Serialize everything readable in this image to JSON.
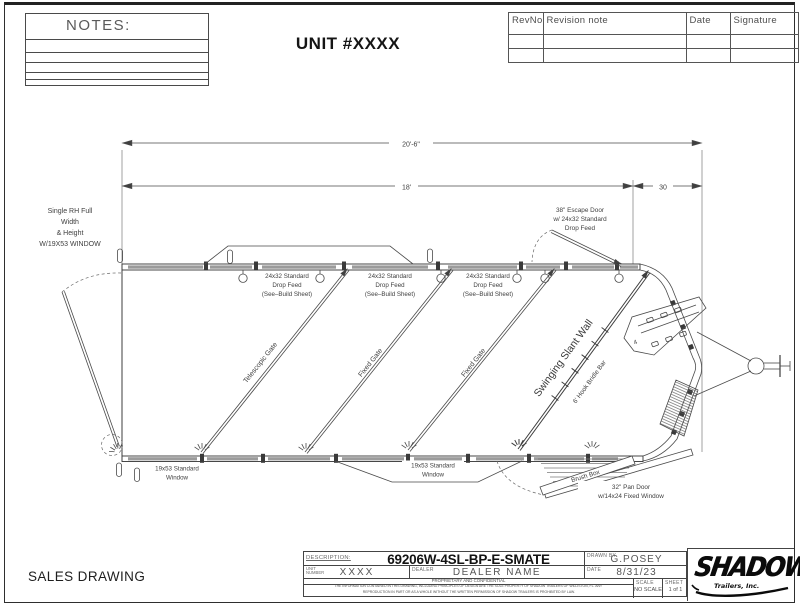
{
  "sheet": {
    "unit_title": "UNIT #XXXX",
    "notes_label": "NOTES:",
    "sales_drawing": "SALES DRAWING"
  },
  "revision_table": {
    "headers": [
      "RevNo",
      "Revision note",
      "Date",
      "Signature"
    ]
  },
  "plan": {
    "dims": {
      "overall": "20'-6\"",
      "floor": "18'",
      "nose": "30"
    },
    "rear_door_label": [
      "Single RH Full",
      "Width",
      "& Height",
      "W/19X53 WINDOW"
    ],
    "escape_door_label": [
      "38\" Escape Door",
      "w/ 24x32 Standard",
      "Drop Feed"
    ],
    "drop_feed_label": [
      "24x32 Standard",
      "Drop Feed",
      "(See–Build Sheet)"
    ],
    "gate_labels": [
      "Telescopic Gate",
      "Fixed Gate",
      "Fixed Gate"
    ],
    "slant_wall_label": "Swinging Slant Wall",
    "bridle_bar_label": "6' Hook Bridle Bar",
    "saddle_rack_count": "4",
    "window_label": [
      "19x53 Standard",
      "Window"
    ],
    "brush_box_label": "Brush Box",
    "pan_door_label": [
      "32\" Pan Door",
      "w/14x24 Fixed Window"
    ]
  },
  "title_block": {
    "description_label": "DESCRIPTION:",
    "description": "69206W-4SL-BP-E-SMATE",
    "unit_number_label_1": "UNIT",
    "unit_number_label_2": "NUMBER",
    "unit_number": "XXXX",
    "dealer_label": "DEALER",
    "dealer": "DEALER NAME",
    "drawn_by_label": "DRAWN BY",
    "drawn_by": "G.POSEY",
    "date_label": "DATE",
    "date": "8/31/23",
    "confidential": "PROPRIETARY AND CONFIDENTIAL",
    "legal_1": "THE INFORMATION CONTAINED IN THIS DRAWING, INCLUDING PRINCIPLES OF DESIGN ARE THE SOLE PROPERTY OF SHADOW TRAILERS OF WILLISTON, FL. ANY",
    "legal_2": "REPRODUCTION IN PART OR AS A WHOLE WITHOUT THE WRITTEN PERMISSION OF SHADOW TRAILERS IS PROHIBITED BY LAW.",
    "scale_label": "SCALE",
    "scale": "NO SCALE",
    "sheet_label": "SHEET",
    "sheet": "1 of 1",
    "logo": "SHADOW",
    "logo_sub": "Trailers, Inc."
  }
}
